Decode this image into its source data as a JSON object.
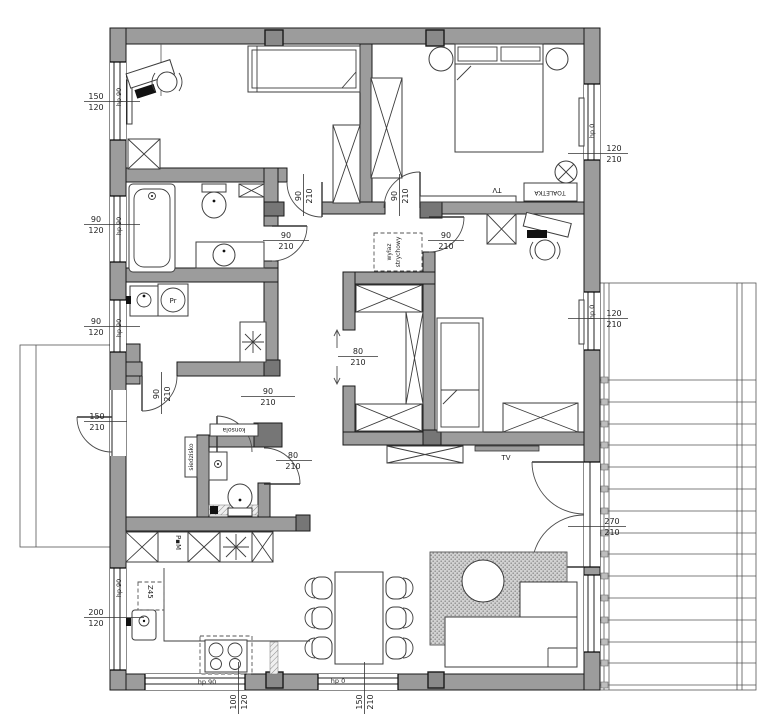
{
  "plan": {
    "type": "architectural-floor-plan",
    "language": "Polish"
  },
  "dims": {
    "win_room1": {
      "num": "150",
      "den": "120",
      "hp": "hp 90"
    },
    "win_bath": {
      "num": "90",
      "den": "120",
      "hp": "hp 90"
    },
    "win_laundry": {
      "num": "90",
      "den": "120",
      "hp": "hp 90"
    },
    "win_kitchen_side": {
      "num": "200",
      "den": "120",
      "hp": "hp 90"
    },
    "win_kitchen_bottom": {
      "num": "100",
      "den": "120",
      "hp": "hp 90"
    },
    "win_dining": {
      "num": "150",
      "den": "210",
      "hp": "hp 0"
    },
    "win_master": {
      "num": "120",
      "den": "210",
      "hp": "hp 0"
    },
    "win_room3": {
      "num": "120",
      "den": "210",
      "hp": "hp 0"
    },
    "door_terrace": {
      "num": "270",
      "den": "210"
    },
    "door_entry": {
      "num": "150",
      "den": "210"
    },
    "door_room1": {
      "num": "90",
      "den": "210"
    },
    "door_master": {
      "num": "90",
      "den": "210"
    },
    "door_bath": {
      "num": "90",
      "den": "210"
    },
    "door_room3": {
      "num": "90",
      "den": "210"
    },
    "door_laundry": {
      "num": "90",
      "den": "210"
    },
    "door_hall": {
      "num": "90",
      "den": "210"
    },
    "door_wc": {
      "num": "80",
      "den": "210"
    },
    "door_closet": {
      "num": "80",
      "den": "210"
    }
  },
  "labels": {
    "dressing_table": "TOALETKA",
    "tv_bedroom": "TV",
    "tv_living": "TV",
    "console": "konsola",
    "seat": "siedzisko",
    "washing_machine": "Pr",
    "dishwasher": "Z45",
    "oven_column": "P▪M",
    "attic_hatch_line1": "wyłaz",
    "attic_hatch_line2": "strychowy"
  },
  "icons": {
    "freezer_laundry": "eight-spoke-star",
    "fridge_kitchen": "eight-spoke-star"
  },
  "colors": {
    "wall": "#9c9c9c",
    "background": "#ffffff",
    "line": "#3d3d3d"
  }
}
